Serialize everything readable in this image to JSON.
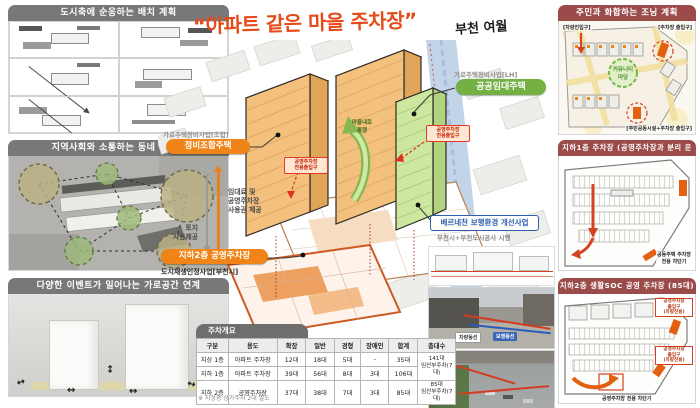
{
  "title": {
    "main": "“아파트 같은 마을 주차장”",
    "sub": "부천 여월"
  },
  "left_panels": {
    "p1": {
      "title": "도시축에 순응하는 배치 계획"
    },
    "p2": {
      "title": "지역사회와 소통하는 동네 만들기"
    },
    "p3": {
      "title": "다양한 이벤트가 일어나는 가로공간 연계"
    }
  },
  "center": {
    "proj_left_small": "가로주택정비사업[조합]",
    "pill_coop": "정비조합주택",
    "arrow_rent": "임대료 및\n공영주차장\n사용권 제공",
    "arrow_land": "토지\n사용제공",
    "pill_b2": "지하2층 공영주차장",
    "b2_sub": "도시재생인정사업[부천시]",
    "proj_right_small": "가로주택정비사업[LH]",
    "pill_public": "공공임대주택",
    "entry_label_left": "공영주차장\n전용출입구",
    "entry_label_right": "공영주차장\n전용출입구",
    "village_path": "마을내로\n통행",
    "berne_title": "베르네천 보행환경 개선사업",
    "berne_sub": "부천시+부천도시공사 시행",
    "photo_tag_vehicle": "차량동선",
    "photo_tag_walk": "보행동선"
  },
  "parking_table": {
    "tab": "주차개요",
    "headers": [
      "구분",
      "용도",
      "확장",
      "일반",
      "경형",
      "장애인",
      "합계",
      "총대수"
    ],
    "rows": [
      {
        "floor": "지상 1층",
        "use": "아파트 주차장",
        "ext": "12대",
        "gen": "18대",
        "compact": "5대",
        "disabled": "-",
        "sum": "35대"
      },
      {
        "floor": "지하 1층",
        "use": "아파트 주차장",
        "ext": "39대",
        "gen": "56대",
        "compact": "8대",
        "disabled": "3대",
        "sum": "106대"
      },
      {
        "floor": "지하 2층",
        "use": "공영주차장",
        "ext": "37대",
        "gen": "38대",
        "compact": "7대",
        "disabled": "3대",
        "sum": "85대"
      }
    ],
    "total_apartment": "141대\n임산부주차(7대)",
    "total_public": "85대\n임산부주차(7대)",
    "footnote": "※ 지상층 상가주차 2대 별도"
  },
  "right_panels": {
    "zoning": {
      "title": "주민과 화합하는 조닝 계획",
      "label_tl": "[차량진입구]",
      "label_tr": "[주차장 출입구]",
      "label_center": "커뮤니티\n마당",
      "label_bottom": "[주민공동시설+주차장 출입구]"
    },
    "b1": {
      "title": "지하1층 주차장 (공영주차장과 분리 운영)",
      "label_barrier": "공동주택 주차장\n전용 차단기"
    },
    "b2": {
      "title": "지하2층 생활SOC 공영 주차장 (85대)",
      "label_entry_top": "공영주차장\n출입구\n(차량전용)",
      "label_entry_bottom": "공영주차장\n출입구\n(차량전용)",
      "label_barrier": "공영주차장 전용 차단기"
    }
  },
  "colors": {
    "accent_orange": "#f08419",
    "accent_green": "#74b042",
    "accent_red": "#d4421f",
    "accent_blue": "#2f5fae",
    "header_gray": "#787878",
    "header_red": "#9c4b4b"
  }
}
